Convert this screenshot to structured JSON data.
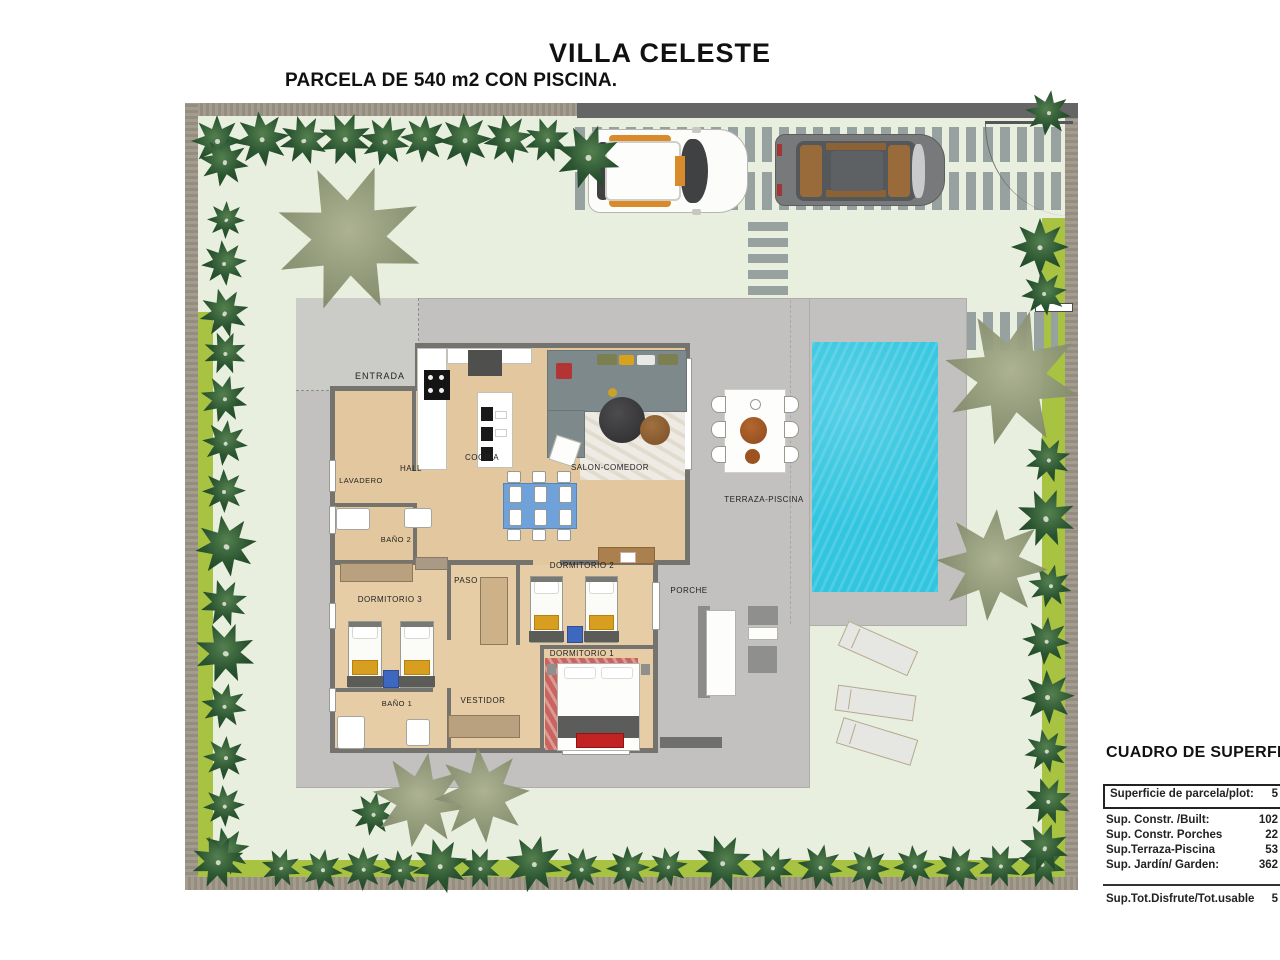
{
  "page": {
    "title": "VILLA CELESTE",
    "subtitle": "PARCELA DE 540 m2 CON PISCINA."
  },
  "plan": {
    "rooms": [
      {
        "label": "ENTRADA"
      },
      {
        "label": "HALL"
      },
      {
        "label": "LAVADERO"
      },
      {
        "label": "COCINA"
      },
      {
        "label": "SALON-COMEDOR"
      },
      {
        "label": "BAÑO 2"
      },
      {
        "label": "PASO"
      },
      {
        "label": "DORMITORIO 2"
      },
      {
        "label": "DORMITORIO 3"
      },
      {
        "label": "DORMITORIO 1"
      },
      {
        "label": "BAÑO 1"
      },
      {
        "label": "VESTIDOR"
      },
      {
        "label": "PORCHE"
      },
      {
        "label": "TERRAZA-PISCINA"
      }
    ],
    "icons": {
      "bush": "round-shrub-icon",
      "palm": "palm-tree-icon",
      "car_white": "white-car-icon",
      "car_gray": "gray-car-icon",
      "pool": "swimming-pool",
      "lounger": "sun-lounger-icon"
    },
    "colors": {
      "garden": "#e9efde",
      "hedge": "#a8c242",
      "wall": "#9c958a",
      "platform": "#c2c1bf",
      "floor": "#e3c89f",
      "pool": "#31c5e0",
      "bush": "#1d4423",
      "palm": "#8c9474"
    }
  },
  "summary": {
    "heading": "CUADRO DE SUPERFI",
    "header_row": {
      "label": "Superficie de parcela/plot:",
      "value": "5"
    },
    "rows": [
      {
        "label": "Sup. Constr. /Built:",
        "value": "102"
      },
      {
        "label": "Sup. Constr. Porches",
        "value": "22"
      },
      {
        "label": "Sup.Terraza-Piscina",
        "value": "53"
      },
      {
        "label": "Sup. Jardín/ Garden:",
        "value": "362"
      }
    ],
    "total_row": {
      "label": "Sup.Tot.Disfrute/Tot.usable",
      "value": "5"
    }
  }
}
